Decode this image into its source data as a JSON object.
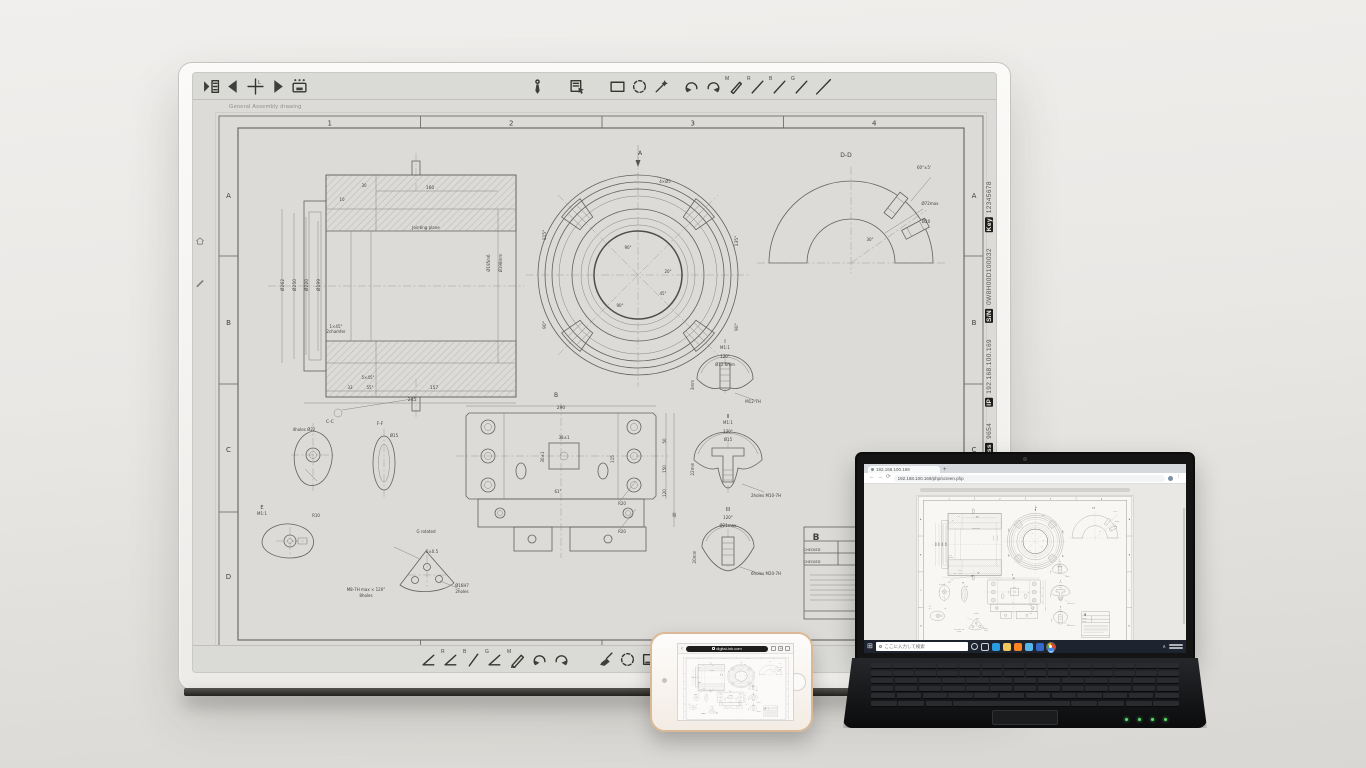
{
  "board": {
    "caption": "General Assembly drawing",
    "toolbar_top": {
      "crosshair_label": "L",
      "pencil_label": "M",
      "pen_labels": [
        "R",
        "B",
        "G"
      ]
    },
    "toolbar_bottom": {
      "pencil_label": "M",
      "pen_labels": [
        "R",
        "B",
        "G"
      ]
    },
    "bezel_labels": [
      {
        "badge": "Key",
        "value": "12345678"
      },
      {
        "badge": "S/N",
        "value": "0W8H00D100032"
      },
      {
        "badge": "IP",
        "value": "192.168.100.169"
      },
      {
        "badge": "Pass",
        "value": "9654"
      }
    ]
  },
  "sheet": {
    "columns": [
      "1",
      "2",
      "3",
      "4"
    ],
    "rows": [
      "A",
      "B",
      "C",
      "D"
    ],
    "annotations": [
      {
        "t": "Ø262",
        "x": 68,
        "y": 172,
        "r": -90,
        "s": 4.5
      },
      {
        "t": "Ø250",
        "x": 80,
        "y": 172,
        "r": -90,
        "s": 4.5
      },
      {
        "t": "Ø220",
        "x": 92,
        "y": 172,
        "r": -90,
        "s": 4.5
      },
      {
        "t": "Ø199",
        "x": 104,
        "y": 172,
        "r": -90,
        "s": 4.5
      },
      {
        "t": "Ø195m6",
        "x": 274,
        "y": 150,
        "r": -90,
        "s": 4
      },
      {
        "t": "Ø198mm",
        "x": 286,
        "y": 150,
        "r": -90,
        "s": 4
      },
      {
        "t": "Jointing plane",
        "x": 210,
        "y": 116,
        "s": 4
      },
      {
        "t": "160",
        "x": 214,
        "y": 76,
        "s": 4.5
      },
      {
        "t": "30",
        "x": 148,
        "y": 74,
        "s": 4
      },
      {
        "t": "10",
        "x": 126,
        "y": 88,
        "s": 4
      },
      {
        "t": "1×45°",
        "x": 120,
        "y": 215,
        "s": 4
      },
      {
        "t": "2chamfer",
        "x": 120,
        "y": 220,
        "s": 4
      },
      {
        "t": "5×45°",
        "x": 152,
        "y": 266,
        "s": 4
      },
      {
        "t": "33",
        "x": 134,
        "y": 276,
        "s": 4
      },
      {
        "t": "55°",
        "x": 154,
        "y": 276,
        "s": 4
      },
      {
        "t": "157",
        "x": 218,
        "y": 276,
        "s": 4.5
      },
      {
        "t": "245",
        "x": 196,
        "y": 288,
        "s": 4.5
      },
      {
        "t": "A",
        "x": 424,
        "y": 42,
        "s": 6
      },
      {
        "t": "4×Ø5",
        "x": 449,
        "y": 70,
        "s": 4
      },
      {
        "t": "115°",
        "x": 330,
        "y": 122,
        "r": -90,
        "s": 4.5
      },
      {
        "t": "90°",
        "x": 330,
        "y": 212,
        "r": -90,
        "s": 4.5
      },
      {
        "t": "135°",
        "x": 522,
        "y": 128,
        "r": -90,
        "s": 4.5
      },
      {
        "t": "90°",
        "x": 522,
        "y": 214,
        "r": -90,
        "s": 4.5
      },
      {
        "t": "90°",
        "x": 412,
        "y": 136,
        "s": 4
      },
      {
        "t": "20°",
        "x": 452,
        "y": 160,
        "s": 4
      },
      {
        "t": "45°",
        "x": 447,
        "y": 182,
        "s": 4
      },
      {
        "t": "90°",
        "x": 404,
        "y": 194,
        "s": 4
      },
      {
        "t": "D-D",
        "x": 630,
        "y": 44,
        "s": 6
      },
      {
        "t": "60°±5'",
        "x": 708,
        "y": 56,
        "s": 4
      },
      {
        "t": "Ø72max",
        "x": 714,
        "y": 92,
        "s": 4
      },
      {
        "t": "Ø20",
        "x": 710,
        "y": 110,
        "s": 4
      },
      {
        "t": "30°",
        "x": 654,
        "y": 128,
        "s": 4
      },
      {
        "t": "B",
        "x": 340,
        "y": 284,
        "s": 6
      },
      {
        "t": "290",
        "x": 345,
        "y": 296,
        "s": 4.5
      },
      {
        "t": "115",
        "x": 398,
        "y": 346,
        "r": -90,
        "s": 4
      },
      {
        "t": "50",
        "x": 450,
        "y": 328,
        "r": -90,
        "s": 4
      },
      {
        "t": "150",
        "x": 450,
        "y": 356,
        "r": -90,
        "s": 4
      },
      {
        "t": "120",
        "x": 450,
        "y": 380,
        "r": -90,
        "s": 4
      },
      {
        "t": "40",
        "x": 460,
        "y": 402,
        "r": -90,
        "s": 4
      },
      {
        "t": "38±1",
        "x": 348,
        "y": 326,
        "s": 4
      },
      {
        "t": "30±1",
        "x": 328,
        "y": 344,
        "r": -90,
        "s": 4
      },
      {
        "t": "61°",
        "x": 342,
        "y": 380,
        "s": 4
      },
      {
        "t": "R20",
        "x": 406,
        "y": 392,
        "s": 4
      },
      {
        "t": "R20",
        "x": 406,
        "y": 420,
        "s": 4
      },
      {
        "t": "I",
        "x": 509,
        "y": 230,
        "s": 5
      },
      {
        "t": "M1:1",
        "x": 509,
        "y": 236,
        "s": 4
      },
      {
        "t": "120°",
        "x": 509,
        "y": 245,
        "s": 4
      },
      {
        "t": "Ø12.6mm",
        "x": 509,
        "y": 253,
        "s": 4
      },
      {
        "t": "3mm",
        "x": 478,
        "y": 272,
        "r": -90,
        "s": 4
      },
      {
        "t": "M12-7H",
        "x": 537,
        "y": 290,
        "s": 4
      },
      {
        "t": "II",
        "x": 512,
        "y": 305,
        "s": 5
      },
      {
        "t": "M1:1",
        "x": 512,
        "y": 311,
        "s": 4
      },
      {
        "t": "120°",
        "x": 512,
        "y": 320,
        "s": 4
      },
      {
        "t": "Ø15",
        "x": 512,
        "y": 328,
        "s": 4
      },
      {
        "t": "22mm",
        "x": 478,
        "y": 356,
        "r": -90,
        "s": 4
      },
      {
        "t": "2holes M10-7H",
        "x": 550,
        "y": 384,
        "s": 4
      },
      {
        "t": "III",
        "x": 512,
        "y": 398,
        "s": 5
      },
      {
        "t": "120°",
        "x": 512,
        "y": 406,
        "s": 4
      },
      {
        "t": "Ø21max",
        "x": 512,
        "y": 414,
        "s": 4
      },
      {
        "t": "20mm",
        "x": 480,
        "y": 444,
        "r": -90,
        "s": 4
      },
      {
        "t": "6holes M20-7H",
        "x": 550,
        "y": 462,
        "s": 4
      },
      {
        "t": "4holes Ø22",
        "x": 88,
        "y": 318,
        "s": 4
      },
      {
        "t": "C-C",
        "x": 114,
        "y": 310,
        "s": 4.5
      },
      {
        "t": "F-F",
        "x": 164,
        "y": 312,
        "s": 4.5
      },
      {
        "t": "Ø15",
        "x": 178,
        "y": 324,
        "s": 4
      },
      {
        "t": "E",
        "x": 46,
        "y": 396,
        "s": 5
      },
      {
        "t": "M1:1",
        "x": 46,
        "y": 402,
        "s": 4
      },
      {
        "t": "R10",
        "x": 100,
        "y": 404,
        "s": 4
      },
      {
        "t": "G rotated",
        "x": 210,
        "y": 420,
        "s": 4
      },
      {
        "t": "5±0.5",
        "x": 216,
        "y": 440,
        "s": 4
      },
      {
        "t": "M8-7H max × 120°",
        "x": 150,
        "y": 478,
        "s": 4
      },
      {
        "t": "8holes",
        "x": 150,
        "y": 484,
        "s": 4
      },
      {
        "t": "Ø16H7",
        "x": 246,
        "y": 474,
        "s": 4
      },
      {
        "t": "2holes",
        "x": 246,
        "y": 480,
        "s": 4
      },
      {
        "t": "B",
        "x": 600,
        "y": 427,
        "s": 9,
        "b": true
      },
      {
        "t": "CHECKED",
        "x": 596,
        "y": 438,
        "s": 3.5
      },
      {
        "t": "CHECKED",
        "x": 596,
        "y": 450,
        "s": 3.5
      }
    ]
  },
  "laptop": {
    "browser": {
      "tab_title": "192.168.100.169",
      "url": "192.168.100.169/php/screen.php"
    },
    "taskbar": {
      "search_placeholder": "ここに入力して検索",
      "icons": [
        {
          "name": "cortana"
        },
        {
          "name": "task-view"
        },
        {
          "name": "edge",
          "color": "#2a9ce0"
        },
        {
          "name": "file-explorer",
          "color": "#f0c75a"
        },
        {
          "name": "firefox",
          "color": "#ff8324"
        },
        {
          "name": "photos",
          "color": "#55b7e8"
        },
        {
          "name": "mail",
          "color": "#3668c9"
        },
        {
          "name": "chrome",
          "active": true
        }
      ]
    }
  },
  "phone": {
    "safari": {
      "url": "digital-ink.com"
    }
  },
  "colors": {
    "board_screen": "#dcdbd7",
    "taskbar": "#1d2430",
    "indicator_green": "#59e06b",
    "chrome_red": "#ea4335",
    "chrome_blue": "#4285f4",
    "chrome_green": "#34a853",
    "chrome_yellow": "#fbbc05"
  }
}
